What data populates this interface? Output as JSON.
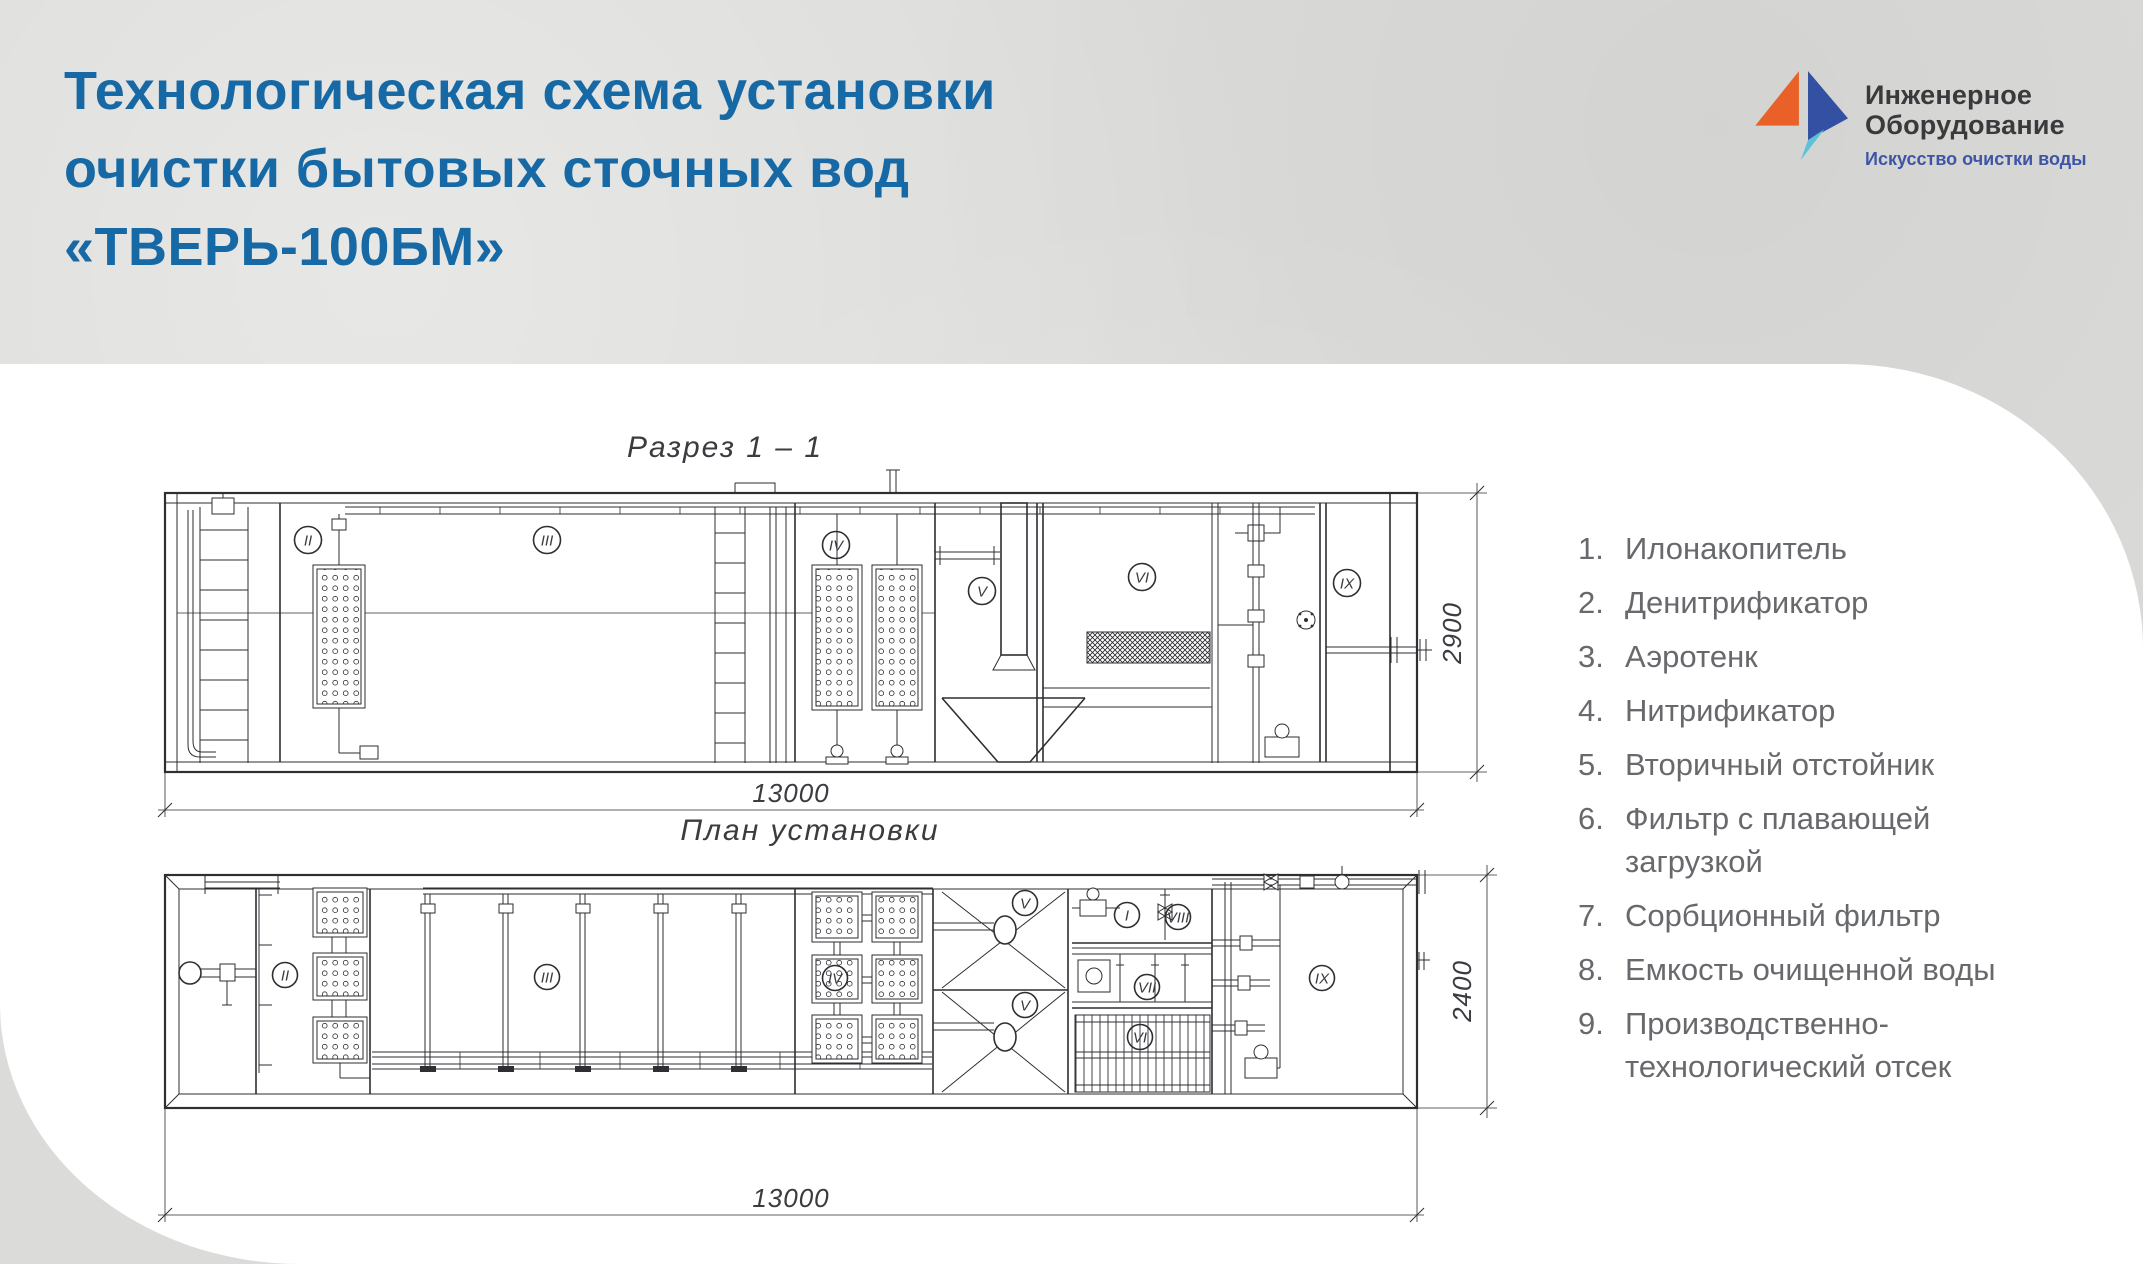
{
  "colors": {
    "title_blue": "#1669a4",
    "logo_orange": "#e96129",
    "logo_blue": "#3450a3",
    "logo_teal": "#5ec1d8",
    "logo_text_dark": "#3a3a3c",
    "tagline_blue": "#3e55a6",
    "legend_text": "#67696c",
    "drawing_ink": "#2e2e33",
    "background_gray": "#dbdbd9",
    "panel_white": "#ffffff"
  },
  "header": {
    "title_line1": "Технологическая схема установки",
    "title_line2": "очистки бытовых сточных вод",
    "title_line3": "«ТВЕРЬ-100БМ»"
  },
  "logo": {
    "company_line1": "Инженерное",
    "company_line2": "Оборудование",
    "tagline": "Искусство очистки воды"
  },
  "section_view": {
    "title": "Разрез 1 – 1",
    "dim_width": "13000",
    "dim_height": "2900",
    "labels": {
      "c2": "II",
      "c3": "III",
      "c4": "IV",
      "c5": "V",
      "c6": "VI",
      "c9": "IX"
    }
  },
  "plan_view": {
    "title": "План установки",
    "dim_width": "13000",
    "dim_height": "2400",
    "labels": {
      "c1": "I",
      "c2": "II",
      "c3": "III",
      "c4": "IV",
      "c5_top": "V",
      "c5_bottom": "V",
      "c6": "VI",
      "c7": "VII",
      "c8": "VIII",
      "c9": "IX"
    }
  },
  "legend": {
    "items": [
      {
        "num": "1.",
        "label": "Илонакопитель"
      },
      {
        "num": "2.",
        "label": "Денитрификатор"
      },
      {
        "num": "3.",
        "label": "Аэротенк"
      },
      {
        "num": "4.",
        "label": "Нитрификатор"
      },
      {
        "num": "5.",
        "label": "Вторичный отстойник"
      },
      {
        "num": "6.",
        "label": "Фильтр с плавающей загрузкой"
      },
      {
        "num": "7.",
        "label": "Сорбционный фильтр"
      },
      {
        "num": "8.",
        "label": "Емкость очищенной воды"
      },
      {
        "num": "9.",
        "label": "Производственно-технологический отсек"
      }
    ]
  }
}
